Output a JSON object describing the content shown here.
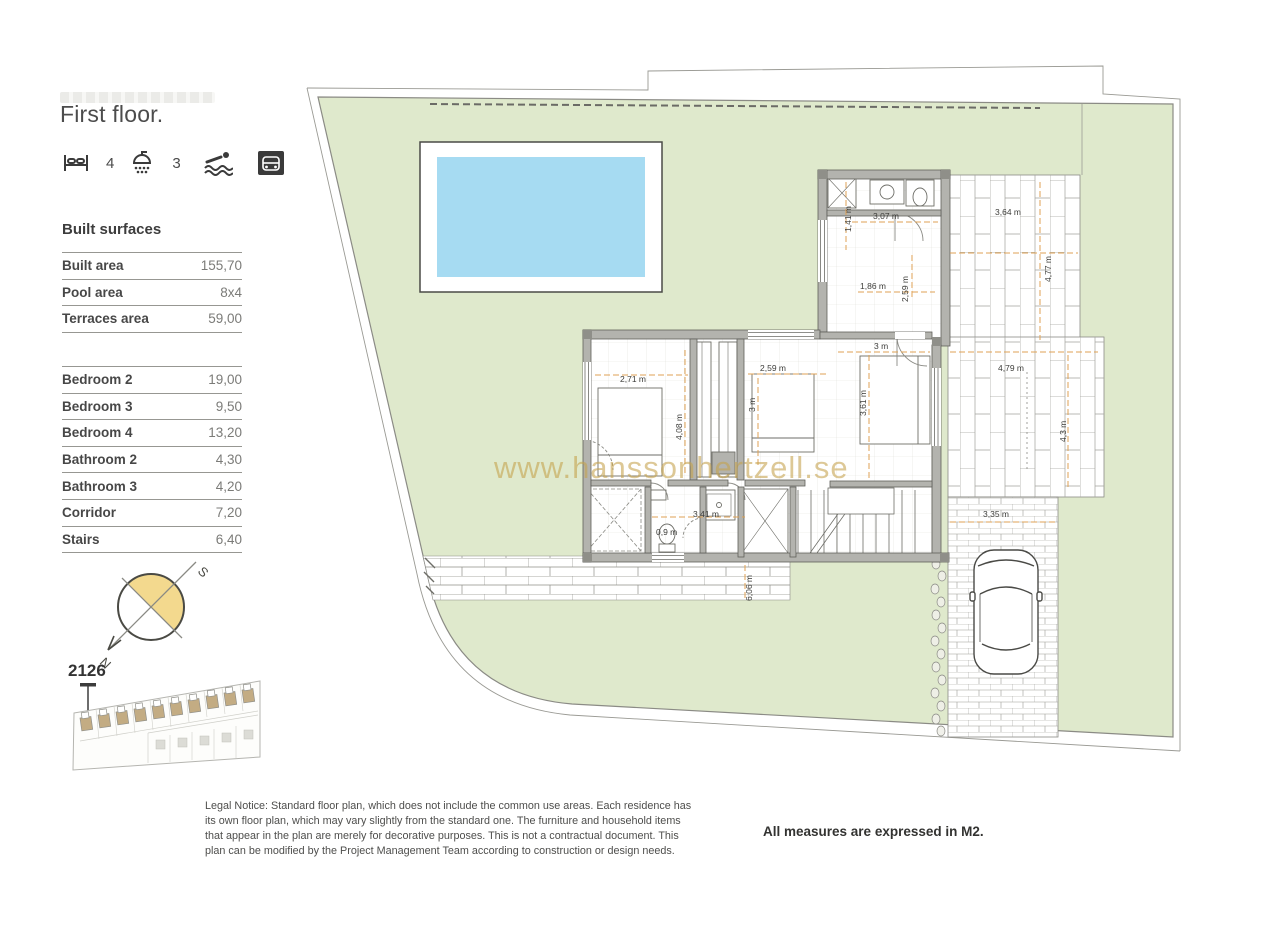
{
  "sidebar": {
    "title": "First floor.",
    "amenities": {
      "beds_count": "4",
      "showers_count": "3"
    },
    "built_surfaces": {
      "heading": "Built surfaces",
      "rows": [
        {
          "label": "Built area",
          "value": "155,70"
        },
        {
          "label": "Pool area",
          "value": "8x4"
        },
        {
          "label": "Terraces area",
          "value": "59,00"
        }
      ]
    },
    "rooms": {
      "rows": [
        {
          "label": "Bedroom 2",
          "value": "19,00"
        },
        {
          "label": "Bedroom 3",
          "value": "9,50"
        },
        {
          "label": "Bedroom 4",
          "value": "13,20"
        },
        {
          "label": "Bathroom 2",
          "value": "4,30"
        },
        {
          "label": "Bathroom 3",
          "value": "4,20"
        },
        {
          "label": "Corridor",
          "value": "7,20"
        },
        {
          "label": "Stairs",
          "value": "6,40"
        }
      ]
    }
  },
  "plan": {
    "unit_number": "2126",
    "watermark": "www.hanssonhertzell.se",
    "compass": {
      "south": "S",
      "north": "N"
    },
    "dims": {
      "closet_depth": "1,41 m",
      "bath2_width": "3,07 m",
      "terrace_top_width": "3,64 m",
      "terrace_top_height": "4,77 m",
      "bath2_inner_width": "1,86 m",
      "bath2_inner_height": "2,59 m",
      "bedroom4_width": "3 m",
      "bedroom2_width": "2,71 m",
      "bedroom2_height": "4,08 m",
      "bedroom3_width": "2,59 m",
      "bedroom3_height": "3 m",
      "bedroom4_height": "3,61 m",
      "terrace_right_width": "4,79 m",
      "terrace_right_height": "4,3 m",
      "corridor_width": "3,41 m",
      "wc_width": "0,9 m",
      "driveway_width": "3,35 m",
      "walkway_length": "6,06 m"
    }
  },
  "footer": {
    "legal_notice": "Legal Notice: Standard floor plan, which does not include the common use areas. Each residence has its own floor plan, which may vary slightly from the standard one. The furniture and household items that appear in the plan are merely for decorative purposes. This is not a contractual document. This plan can be modified by the Project Management Team according to construction or design needs.",
    "measures_note": "All measures are expressed in M2."
  },
  "colors": {
    "plot_green": "#dfe9cc",
    "pool_blue": "#a6dbf2",
    "wall_gray": "#b3b3ae",
    "dimension_orange": "#dfa254",
    "watermark_tan": "#c5a24b",
    "compass_yellow": "#f3d98e"
  }
}
